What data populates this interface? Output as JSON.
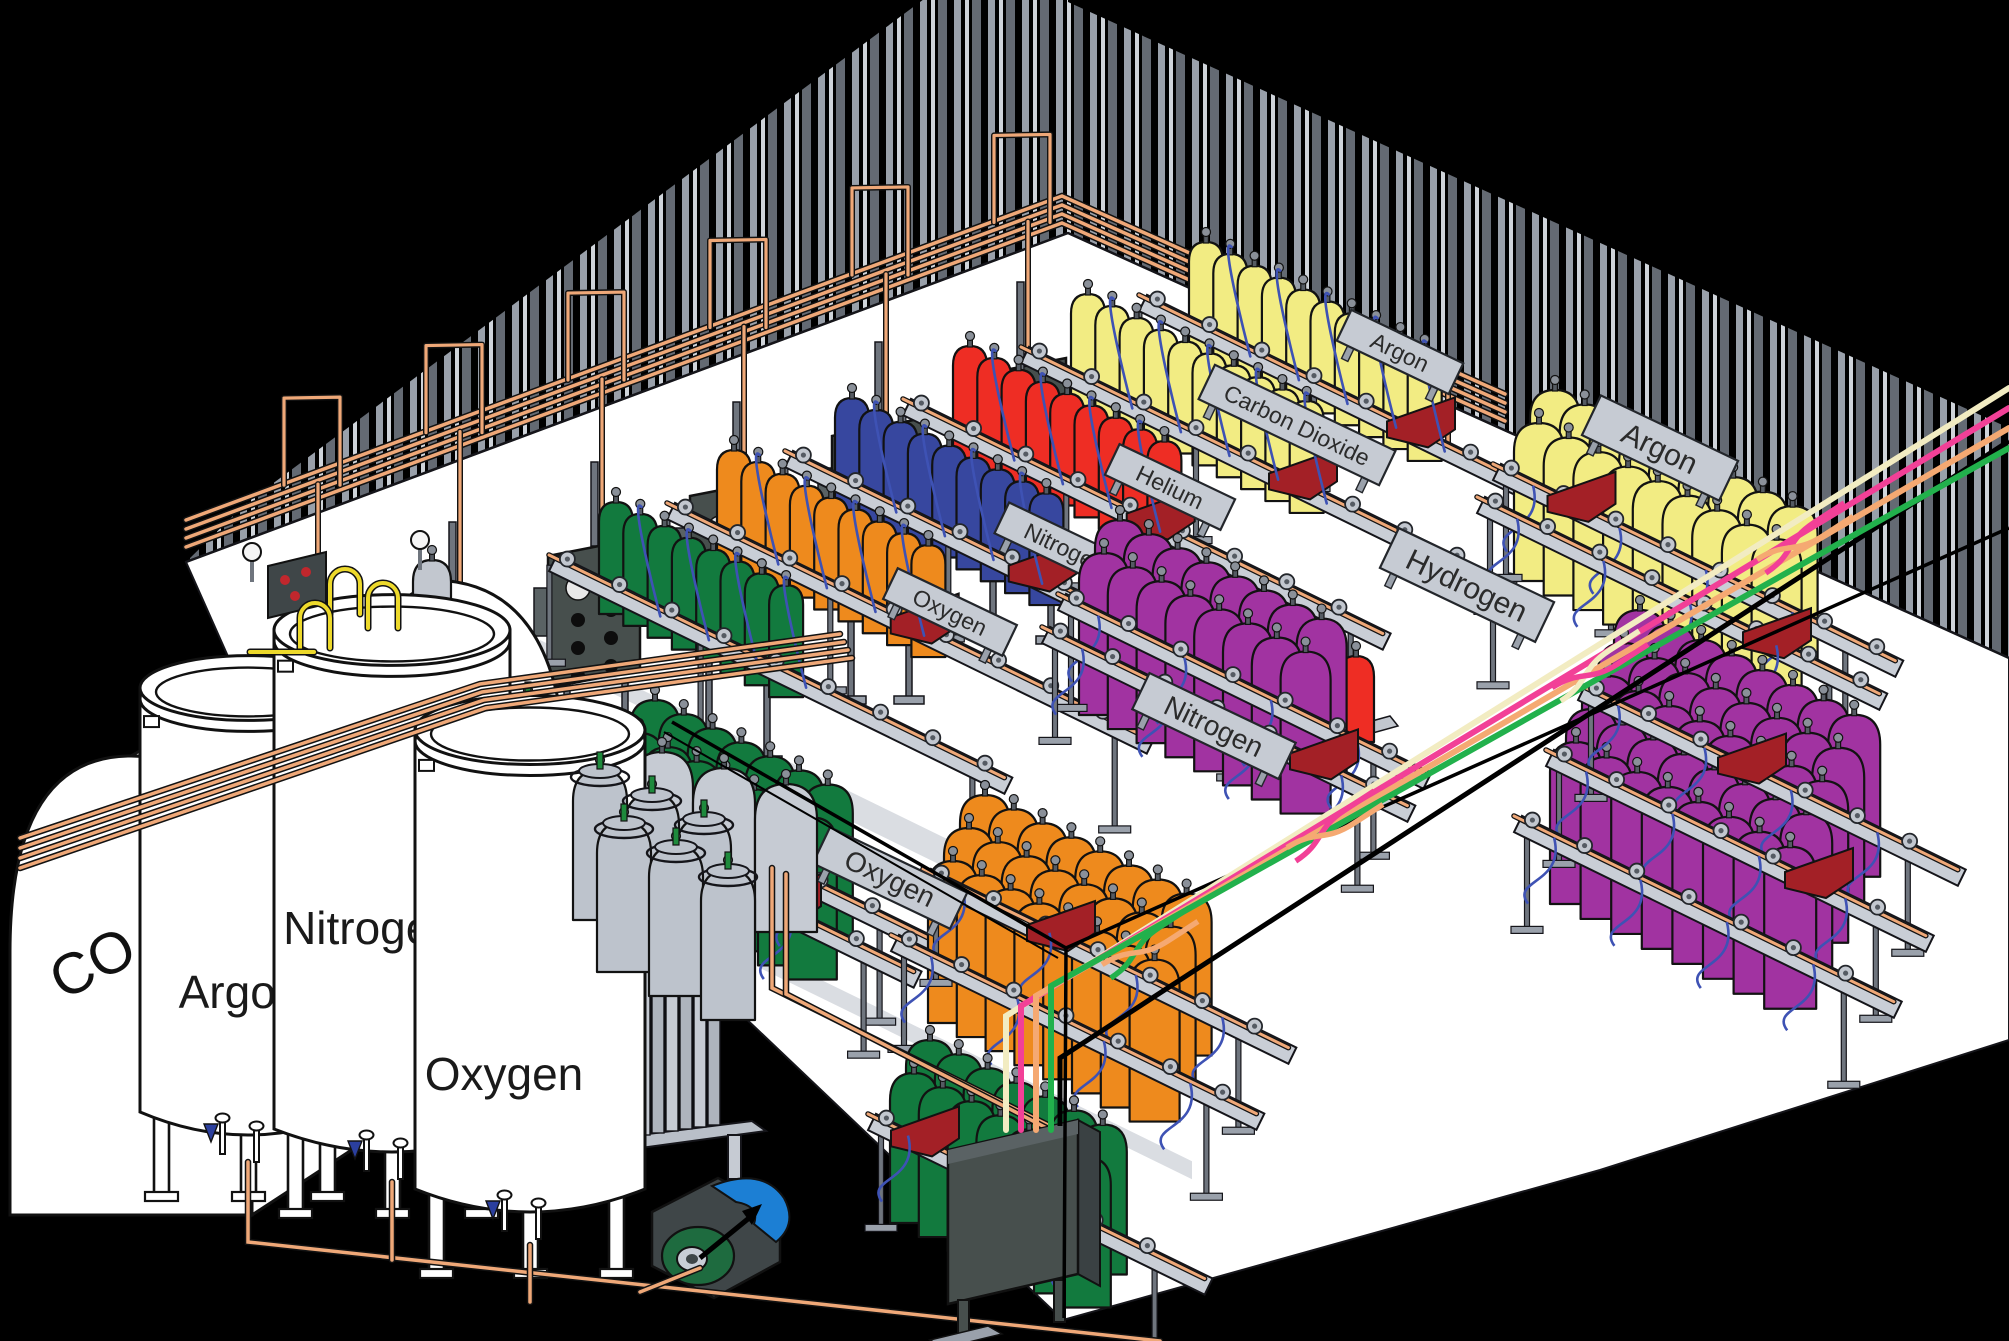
{
  "diagram": {
    "type": "isometric-gas-cylinder-filling-plant",
    "bulk_tanks": [
      {
        "id": "co2-horizontal-tank",
        "label_main": "CO",
        "label_sub": "2"
      },
      {
        "id": "argon-cryo-tank",
        "label": "Argon"
      },
      {
        "id": "nitrogen-cryo-tank",
        "label": "Nitrogen"
      },
      {
        "id": "oxygen-cryo-tank",
        "label": "Oxygen"
      }
    ],
    "cylinder_groups": [
      {
        "id": "back-row-oxygen",
        "color": "#127A3E",
        "count": 8,
        "sign": "Oxygen"
      },
      {
        "id": "back-row-orange",
        "color": "#EE8A1D",
        "count": 9,
        "sign": null
      },
      {
        "id": "back-row-nitrogen",
        "color": "#37479F",
        "count": 9,
        "sign": "Nitrogen"
      },
      {
        "id": "back-row-helium",
        "color": "#EE2D24",
        "count": 9,
        "sign": "Helium"
      },
      {
        "id": "back-row-carbon-dioxide",
        "color": "#F2EC83",
        "count": 10,
        "sign": "Carbon Dioxide"
      },
      {
        "id": "back-row-argon",
        "color": "#F2EC83",
        "count": 10,
        "sign": "Argon"
      },
      {
        "id": "front-cluster-oxygen",
        "color": "#127A3E",
        "lines": 2,
        "per_line": 7,
        "sign": "Oxygen"
      },
      {
        "id": "front-cluster-oxygen-2",
        "color": "#127A3E",
        "lines": 2,
        "per_line": 7,
        "sign": null
      },
      {
        "id": "front-cluster-nitrogen",
        "color": "#EE8A1D",
        "lines": 3,
        "per_line": 8,
        "sign": "Nitrogen"
      },
      {
        "id": "front-cluster-hydrogen",
        "color": "#A133A1",
        "lines": 2,
        "per_line": 8,
        "sign": "Hydrogen"
      },
      {
        "id": "front-cluster-hydrogen-2",
        "color": "#A133A1",
        "lines": 5,
        "per_line": 8,
        "sign": null
      },
      {
        "id": "front-cluster-argon",
        "color": "#F2EC83",
        "lines": 2,
        "per_line": 9,
        "sign": "Argon"
      }
    ],
    "supply_lines": [
      {
        "id": "supply-line-cream",
        "color": "#F2ECC2"
      },
      {
        "id": "supply-line-pink",
        "color": "#F24097"
      },
      {
        "id": "supply-line-peach",
        "color": "#F5A972"
      },
      {
        "id": "supply-line-green",
        "color": "#22B14C"
      }
    ],
    "palette": {
      "background": "#000000",
      "floor": "#FFFFFF",
      "wall_stripe_light": "#99A0AA",
      "wall_stripe_bright": "#CFD4DA",
      "wall_stripe_dark": "#646A73",
      "copper_pipe": "#EFA878",
      "yellow_pipe": "#EDD92B",
      "rail_gray": "#C9CED6",
      "sign_gray": "#C6CBD3",
      "panel_gray": "#474F4D",
      "hose_blue": "#3E52B4",
      "cart_red": "#A32026",
      "skid_blue": "#3D4B9E",
      "cylinder_gray": "#BDC3CC",
      "pump_blue": "#1C7FD4",
      "pump_green": "#1E6B3F",
      "tank_white": "#FFFFFF"
    }
  }
}
